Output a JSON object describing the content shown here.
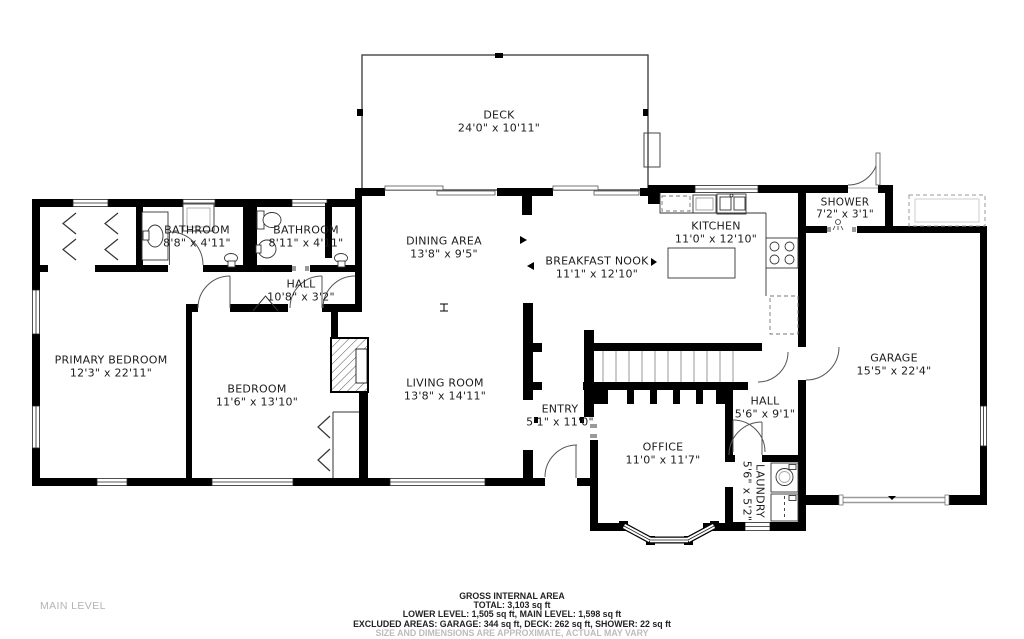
{
  "level_label": "MAIN LEVEL",
  "rooms": {
    "deck": {
      "name": "DECK",
      "dims": "24'0\" x 10'11\""
    },
    "bathroom1": {
      "name": "BATHROOM",
      "dims": "8'8\" x 4'11\""
    },
    "bathroom2": {
      "name": "BATHROOM",
      "dims": "8'11\" x 4'11\""
    },
    "dining_area": {
      "name": "DINING AREA",
      "dims": "13'8\" x 9'5\""
    },
    "breakfast_nook": {
      "name": "BREAKFAST NOOK",
      "dims": "11'1\" x 12'10\""
    },
    "kitchen": {
      "name": "KITCHEN",
      "dims": "11'0\" x 12'10\""
    },
    "shower": {
      "name": "SHOWER",
      "dims": "7'2\" x 3'1\""
    },
    "hall_upper": {
      "name": "HALL",
      "dims": "10'8\" x 3'2\""
    },
    "primary_bedroom": {
      "name": "PRIMARY BEDROOM",
      "dims": "12'3\" x 22'11\""
    },
    "bedroom": {
      "name": "BEDROOM",
      "dims": "11'6\" x 13'10\""
    },
    "living_room": {
      "name": "LIVING ROOM",
      "dims": "13'8\" x 14'11\""
    },
    "entry": {
      "name": "ENTRY",
      "dims": "5'1\" x 11'0\""
    },
    "office": {
      "name": "OFFICE",
      "dims": "11'0\" x 11'7\""
    },
    "hall_lower": {
      "name": "HALL",
      "dims": "5'6\" x 9'1\""
    },
    "laundry": {
      "name": "LAUNDRY",
      "dims": "5'6\" x 5'2\""
    },
    "garage": {
      "name": "GARAGE",
      "dims": "15'5\" x 22'4\""
    }
  },
  "footer": {
    "title": "GROSS INTERNAL AREA",
    "total": "TOTAL: 3,103 sq ft",
    "levels": "LOWER LEVEL: 1,505 sq ft, MAIN LEVEL: 1,598 sq ft",
    "excluded": "EXCLUDED AREAS: GARAGE: 344 sq ft, DECK: 262 sq ft, SHOWER: 22 sq ft",
    "disclaimer": "SIZE AND DIMENSIONS ARE APPROXIMATE, ACTUAL MAY VARY"
  },
  "colors": {
    "walls": "#000000",
    "labels": "#1c1c1c",
    "muted_text": "#b3b3b3"
  }
}
